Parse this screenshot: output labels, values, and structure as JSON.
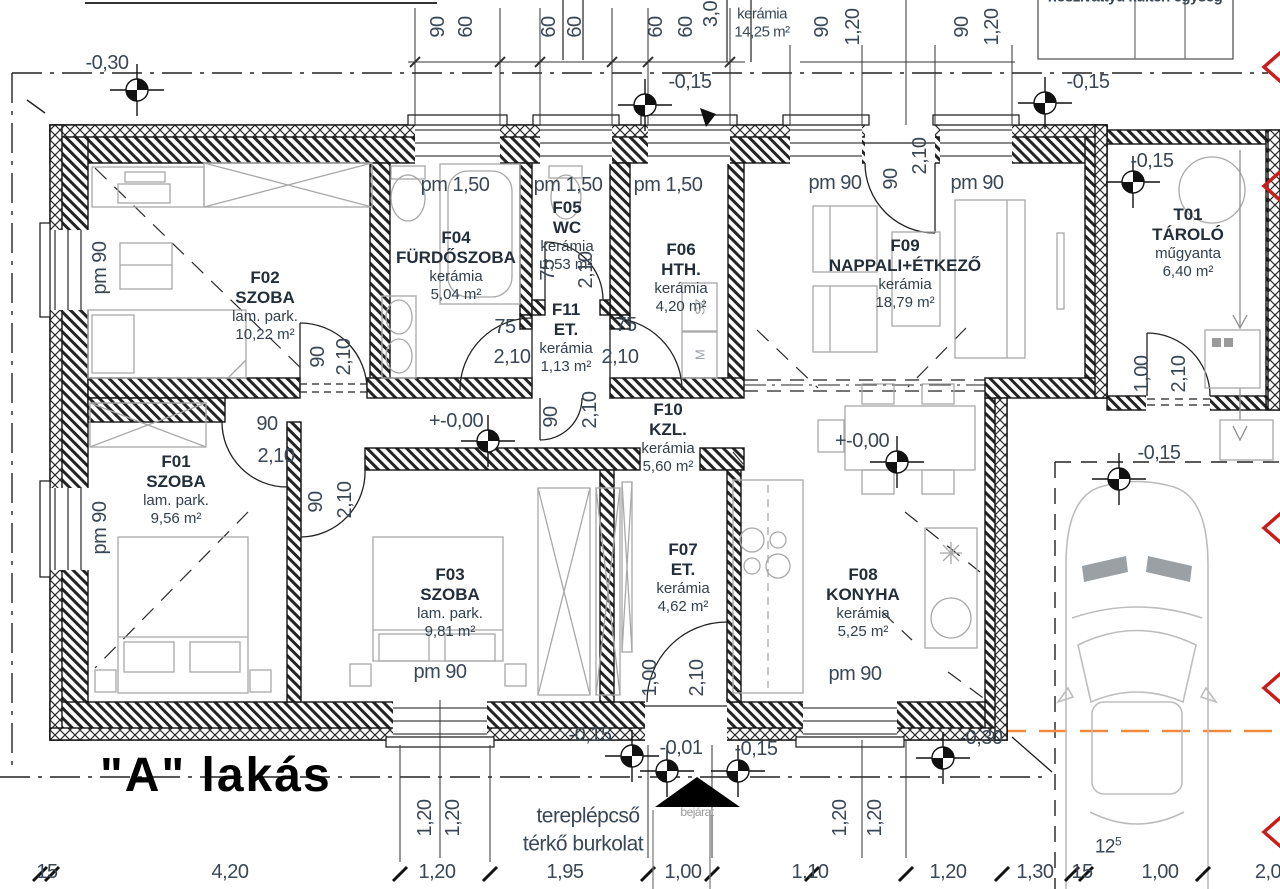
{
  "title": {
    "apartment_label": "\"A\" lakás"
  },
  "top_clipped": {
    "equipment_label": "hőszivattyú kültéri egység",
    "room_finish": "kerámia",
    "room_area": "14,25 m²"
  },
  "rooms": [
    {
      "id": "F01",
      "name": "SZOBA",
      "finish": "lam. park.",
      "area": "9,56 m²"
    },
    {
      "id": "F02",
      "name": "SZOBA",
      "finish": "lam. park.",
      "area": "10,22 m²"
    },
    {
      "id": "F03",
      "name": "SZOBA",
      "finish": "lam. park.",
      "area": "9,81 m²"
    },
    {
      "id": "F04",
      "name": "FÜRDŐSZOBA",
      "finish": "kerámia",
      "area": "5,04 m²"
    },
    {
      "id": "F05",
      "name": "WC",
      "finish": "kerámia",
      "area": "1,53 m²"
    },
    {
      "id": "F06",
      "name": "HTH.",
      "finish": "kerámia",
      "area": "4,20 m²"
    },
    {
      "id": "F07",
      "name": "ET.",
      "finish": "kerámia",
      "area": "4,62 m²"
    },
    {
      "id": "F08",
      "name": "KONYHA",
      "finish": "kerámia",
      "area": "5,25 m²"
    },
    {
      "id": "F09",
      "name": "NAPPALI+ÉTKEZŐ",
      "finish": "kerámia",
      "area": "18,79 m²"
    },
    {
      "id": "F10",
      "name": "KZL.",
      "finish": "kerámia",
      "area": "5,60 m²"
    },
    {
      "id": "F11",
      "name": "ET.",
      "finish": "kerámia",
      "area": "1,13 m²"
    },
    {
      "id": "T01",
      "name": "TÁROLÓ",
      "finish": "műgyanta",
      "area": "6,40 m²"
    }
  ],
  "annotations": {
    "terrain_steps": "tereplépcső",
    "paving": "térkő burkolat",
    "entrance": "bejárat",
    "car_dim_main": "12",
    "car_dim_sup": "5",
    "dryer": "SZ",
    "washer": "M"
  },
  "window_labels": [
    "pm 90",
    "pm 90",
    "pm 1,50",
    "pm 1,50",
    "pm 1,50",
    "pm 90",
    "pm 90",
    "pm 90",
    "pm 90"
  ],
  "door_dims": [
    {
      "w": "90",
      "h": "2,10"
    },
    {
      "w": "90",
      "h": "2,10"
    },
    {
      "w": "75",
      "h": "2,10"
    },
    {
      "w": "75",
      "h": "2,10"
    },
    {
      "w": "75",
      "h": "2,10"
    },
    {
      "w": "90",
      "h": "2,10"
    },
    {
      "w": "90",
      "h": "2,10"
    },
    {
      "w": "1,00",
      "h": "2,10"
    },
    {
      "w": "90",
      "h": "2,10"
    },
    {
      "w": "1,00",
      "h": "2,10"
    }
  ],
  "level_labels": [
    "-0,30",
    "-0,15",
    "-0,15",
    "-0,15",
    "+-0,00",
    "+-0,00",
    "-0,15",
    "-0,15",
    "-0,01",
    "-0,15",
    "-0,30"
  ],
  "top_dims": [
    "90",
    "60",
    "60",
    "60",
    "60",
    "60",
    "3,0",
    "90",
    "1,20",
    "90",
    "1,20"
  ],
  "bottom_dims": [
    "15",
    "4,20",
    "1,20",
    "1,95",
    "1,00",
    "1,10",
    "1,20",
    "1,30",
    "15",
    "1,00",
    "2,0"
  ],
  "vertical_dims": [
    "1,20",
    "1,20",
    "1,20",
    "1,20"
  ],
  "colors": {
    "accent_orange": "#f08a3c",
    "section_red": "#c81e1e",
    "dim_text": "#3a4756",
    "ink": "#141414",
    "furniture_gray": "#a8a8a8"
  }
}
